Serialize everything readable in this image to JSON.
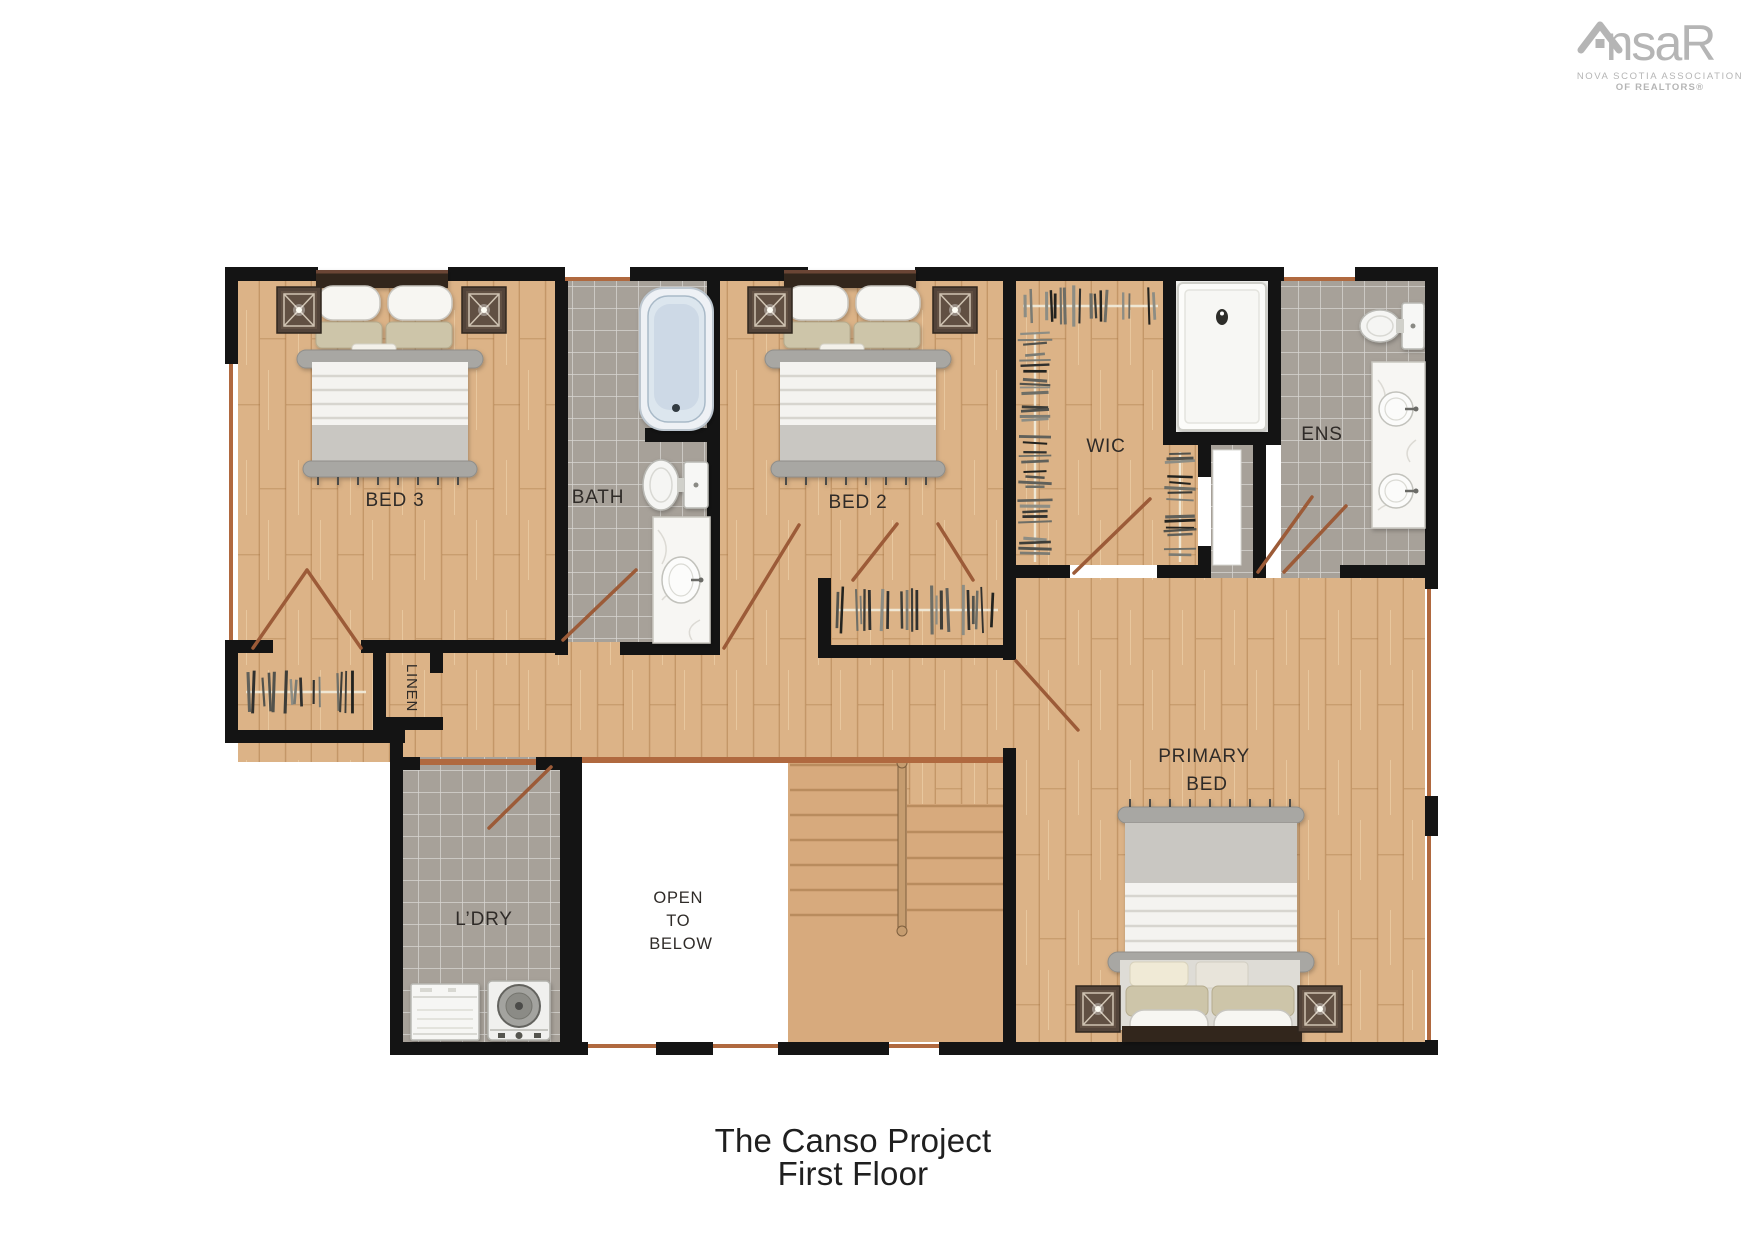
{
  "title": {
    "line1": "The Canso Project",
    "line2": "First Floor"
  },
  "logo": {
    "brand_left": "ns",
    "brand_right": "aR",
    "subline1": "NOVA SCOTIA ASSOCIATION",
    "subline2": "OF REALTORS®"
  },
  "rooms": {
    "bed3": "BED 3",
    "bath": "BATH",
    "bed2": "BED 2",
    "wic": "WIC",
    "ens": "ENS",
    "linen": "LINEN",
    "ldry": "L’DRY",
    "open": {
      "l1": "OPEN",
      "l2": "TO",
      "l3": "BELOW"
    },
    "primary": {
      "l1": "PRIMARY",
      "l2": "BED"
    }
  },
  "colors": {
    "wall": "#141414",
    "wood": "#dcb387",
    "wood_plank_line": "#c9a070",
    "tile": "#a7a199",
    "stairs": "#d7aa7d",
    "stair_tread": "#b98c5e",
    "open_white": "#ffffff",
    "door_swing": "#9c5b38",
    "window_sill": "#b0693f",
    "label_text": "#2f2b28",
    "title_text": "#1f1f1f",
    "logo_gray": "#b5b5b5"
  }
}
